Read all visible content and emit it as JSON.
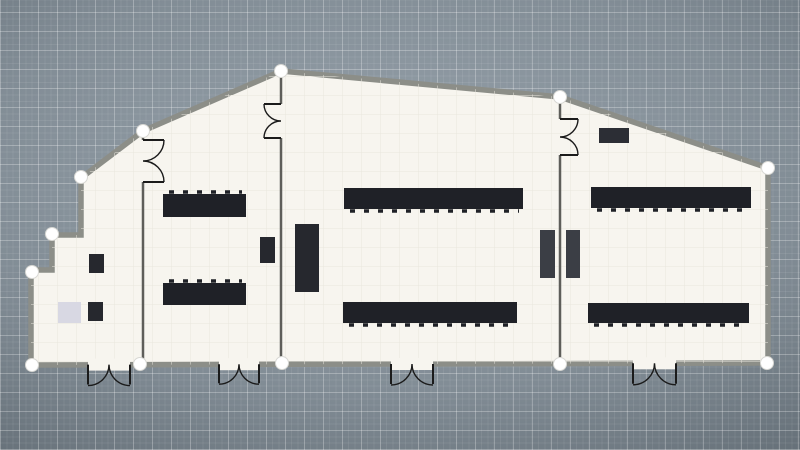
{
  "app": {
    "view": "floor-plan-canvas"
  },
  "palette": {
    "floor": "#f7f5ef",
    "floor_grid": "#e9e6de",
    "exterior_wall": "#8c8e88",
    "interior_wall": "#5e5e5a",
    "door_stroke": "#1b1b1b",
    "handle_fill": "#ffffff",
    "handle_stroke": "#d8d8d4",
    "table": "#1f2127",
    "cabinet": "#26282e",
    "unit": "#3b3e45",
    "board": "#2c2e35",
    "mat": "#d8d8e3"
  },
  "plan": {
    "outline": [
      [
        281,
        71
      ],
      [
        560,
        97
      ],
      [
        768,
        168
      ],
      [
        768,
        363
      ],
      [
        31,
        365
      ],
      [
        31,
        270
      ],
      [
        52,
        270
      ],
      [
        52,
        235
      ],
      [
        81,
        235
      ],
      [
        81,
        178
      ],
      [
        143,
        131
      ]
    ],
    "interior_walls": [
      {
        "x": 143,
        "y1": 131,
        "y2": 364,
        "gap": [
          140,
          182
        ]
      },
      {
        "x": 281,
        "y1": 71,
        "y2": 364,
        "gap": [
          104,
          138
        ]
      },
      {
        "x": 560,
        "y1": 97,
        "y2": 364,
        "gap": [
          119,
          155
        ]
      }
    ],
    "interior_doors": [
      {
        "wall_x": 143,
        "y1": 140,
        "y2": 182,
        "dir": 1
      },
      {
        "wall_x": 281,
        "y1": 104,
        "y2": 138,
        "dir": -1
      },
      {
        "wall_x": 560,
        "y1": 119,
        "y2": 155,
        "dir": 1
      }
    ],
    "bottom_doors": [
      {
        "x1": 88,
        "x2": 130,
        "y": 364.6
      },
      {
        "x1": 219,
        "x2": 259,
        "y": 364.2
      },
      {
        "x1": 391,
        "x2": 433,
        "y": 364.0
      },
      {
        "x1": 633,
        "x2": 676,
        "y": 363.3
      }
    ],
    "furniture": [
      {
        "name": "storage-box",
        "kind": "cabinet",
        "x": 89,
        "y": 254,
        "w": 15,
        "h": 19
      },
      {
        "name": "storage-box",
        "kind": "cabinet",
        "x": 88,
        "y": 302,
        "w": 15,
        "h": 19
      },
      {
        "name": "floor-mat",
        "kind": "mat",
        "x": 58,
        "y": 302,
        "w": 23,
        "h": 21
      },
      {
        "name": "table",
        "kind": "table",
        "x": 163,
        "y": 194,
        "w": 83,
        "h": 23,
        "notch": "top"
      },
      {
        "name": "table",
        "kind": "table",
        "x": 163,
        "y": 283,
        "w": 83,
        "h": 22,
        "notch": "top"
      },
      {
        "name": "cabinet",
        "kind": "cabinet",
        "x": 260,
        "y": 237,
        "w": 15,
        "h": 26
      },
      {
        "name": "cabinet",
        "kind": "cabinet",
        "x": 295,
        "y": 224,
        "w": 24,
        "h": 68
      },
      {
        "name": "long-table",
        "kind": "table",
        "x": 344,
        "y": 188,
        "w": 179,
        "h": 21,
        "notch": "bottom"
      },
      {
        "name": "long-table",
        "kind": "table",
        "x": 343,
        "y": 302,
        "w": 174,
        "h": 21,
        "notch": "bottom"
      },
      {
        "name": "wall-unit",
        "kind": "unit",
        "x": 540,
        "y": 230,
        "w": 15,
        "h": 48
      },
      {
        "name": "wall-unit",
        "kind": "unit",
        "x": 566,
        "y": 230,
        "w": 14,
        "h": 48
      },
      {
        "name": "wall-board",
        "kind": "board",
        "x": 599,
        "y": 128,
        "w": 30,
        "h": 15
      },
      {
        "name": "long-table",
        "kind": "table",
        "x": 591,
        "y": 187,
        "w": 160,
        "h": 21,
        "notch": "bottom"
      },
      {
        "name": "long-table",
        "kind": "table",
        "x": 588,
        "y": 303,
        "w": 161,
        "h": 20,
        "notch": "bottom"
      }
    ],
    "handles": [
      [
        281,
        71
      ],
      [
        560,
        97
      ],
      [
        768,
        168
      ],
      [
        767,
        363
      ],
      [
        560,
        364
      ],
      [
        282,
        363
      ],
      [
        140,
        364
      ],
      [
        32,
        365
      ],
      [
        32,
        272
      ],
      [
        52,
        234
      ],
      [
        81,
        177
      ],
      [
        143,
        131
      ]
    ]
  }
}
